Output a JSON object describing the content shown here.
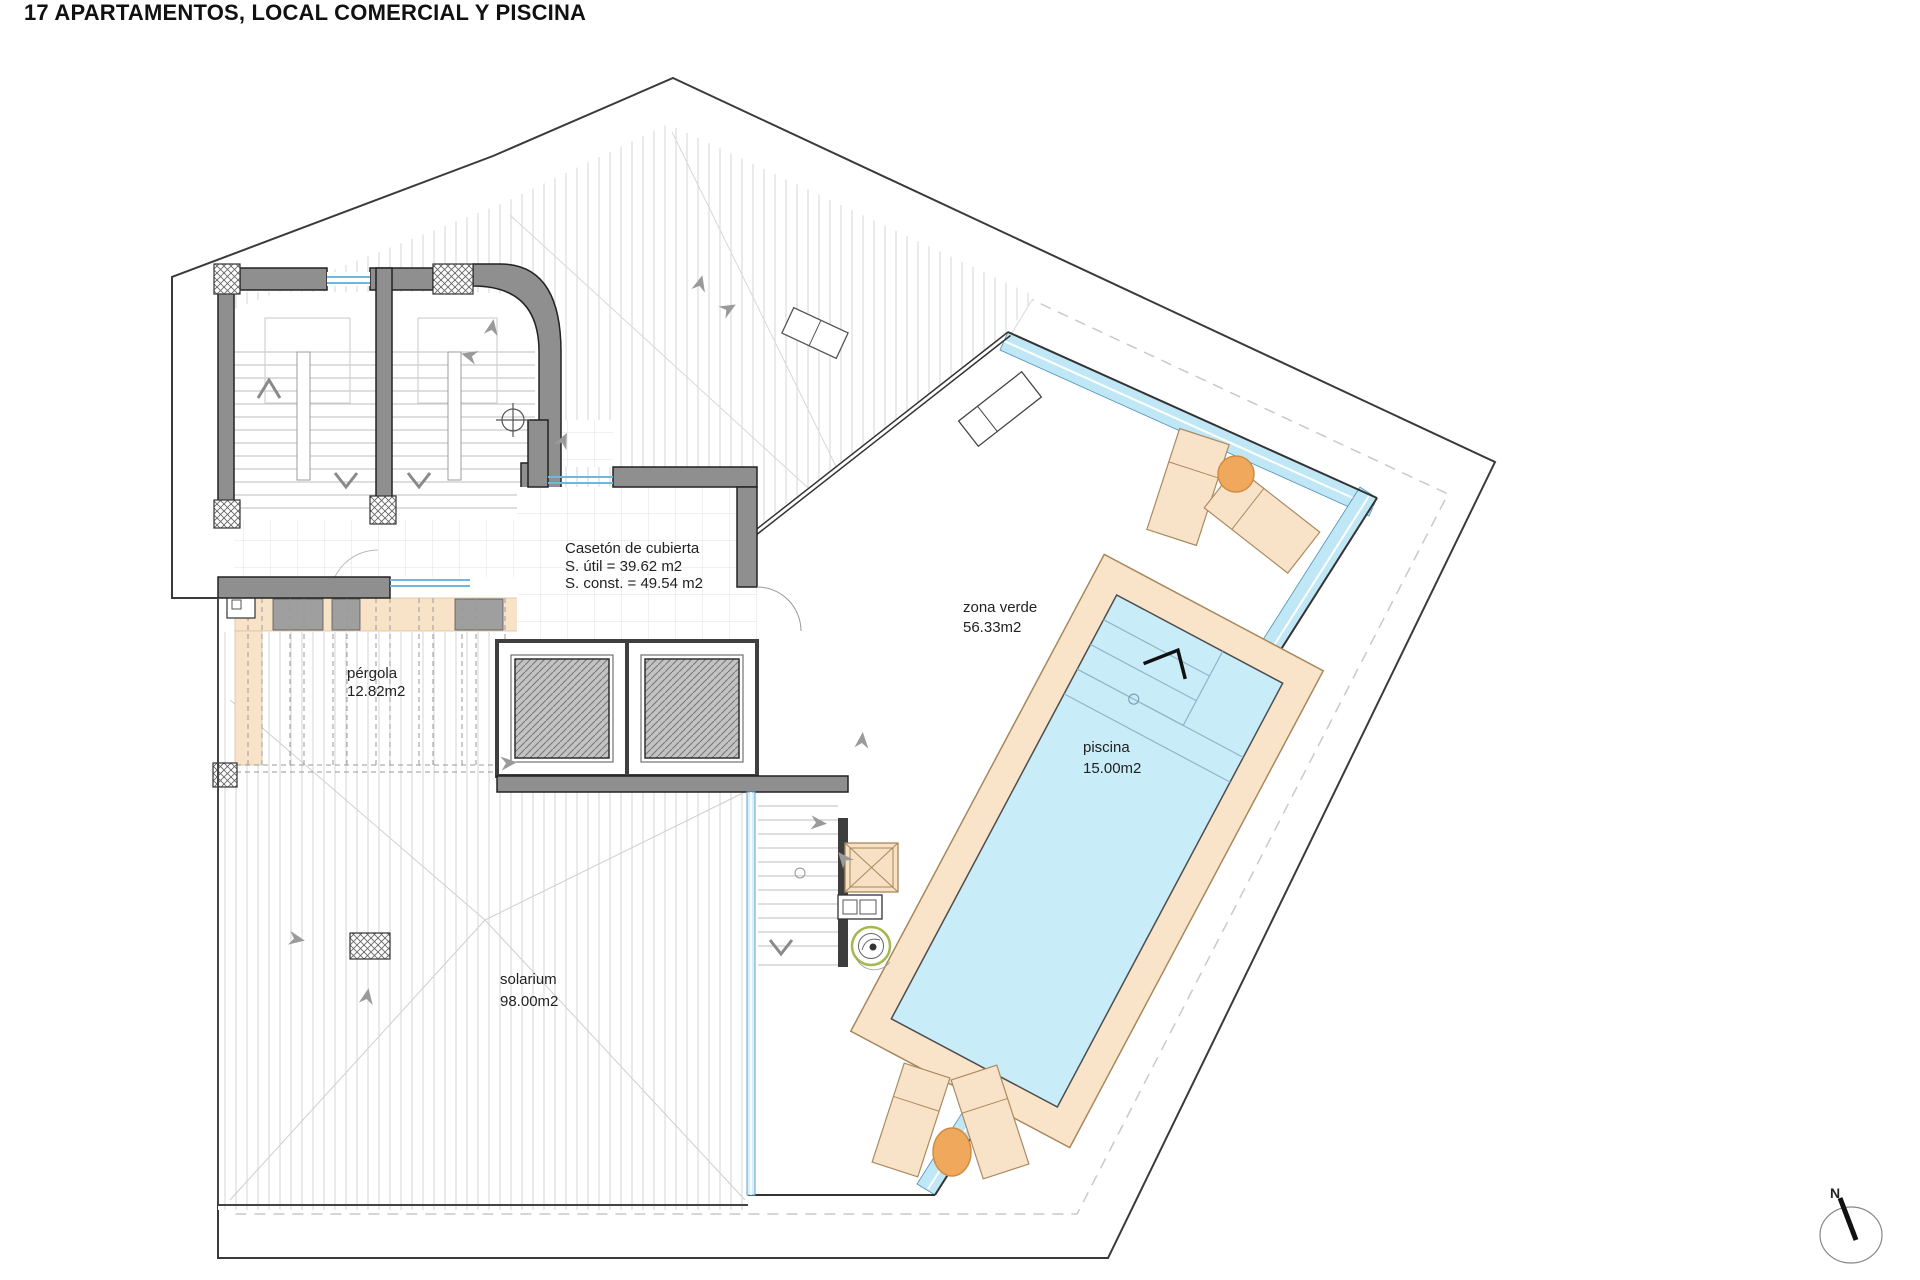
{
  "title": "17 APARTAMENTOS, LOCAL COMERCIAL Y PISCINA",
  "plan": {
    "caseton": {
      "name": "Casetón de cubierta",
      "area_util": "S. útil = 39.62 m2",
      "area_const": "S. const. = 49.54 m2"
    },
    "pergola": {
      "name": "pérgola",
      "area": "12.82m2"
    },
    "zona_verde": {
      "name": "zona verde",
      "area": "56.33m2"
    },
    "piscina": {
      "name": "piscina",
      "area": "15.00m2"
    },
    "solarium": {
      "name": "solarium",
      "area": "98.00m2"
    },
    "north": {
      "label": "N"
    },
    "colors": {
      "pool_water": "#c9ecf9",
      "glass_channel": "#bfe7f5",
      "deck": "#f9e4c9",
      "pergola_band": "#f8e3c8",
      "lounger": "#f8e3c8",
      "umbrella": "#f0a95c",
      "wall": "#8f8f8f",
      "planter_green": "#a3b94c"
    }
  }
}
